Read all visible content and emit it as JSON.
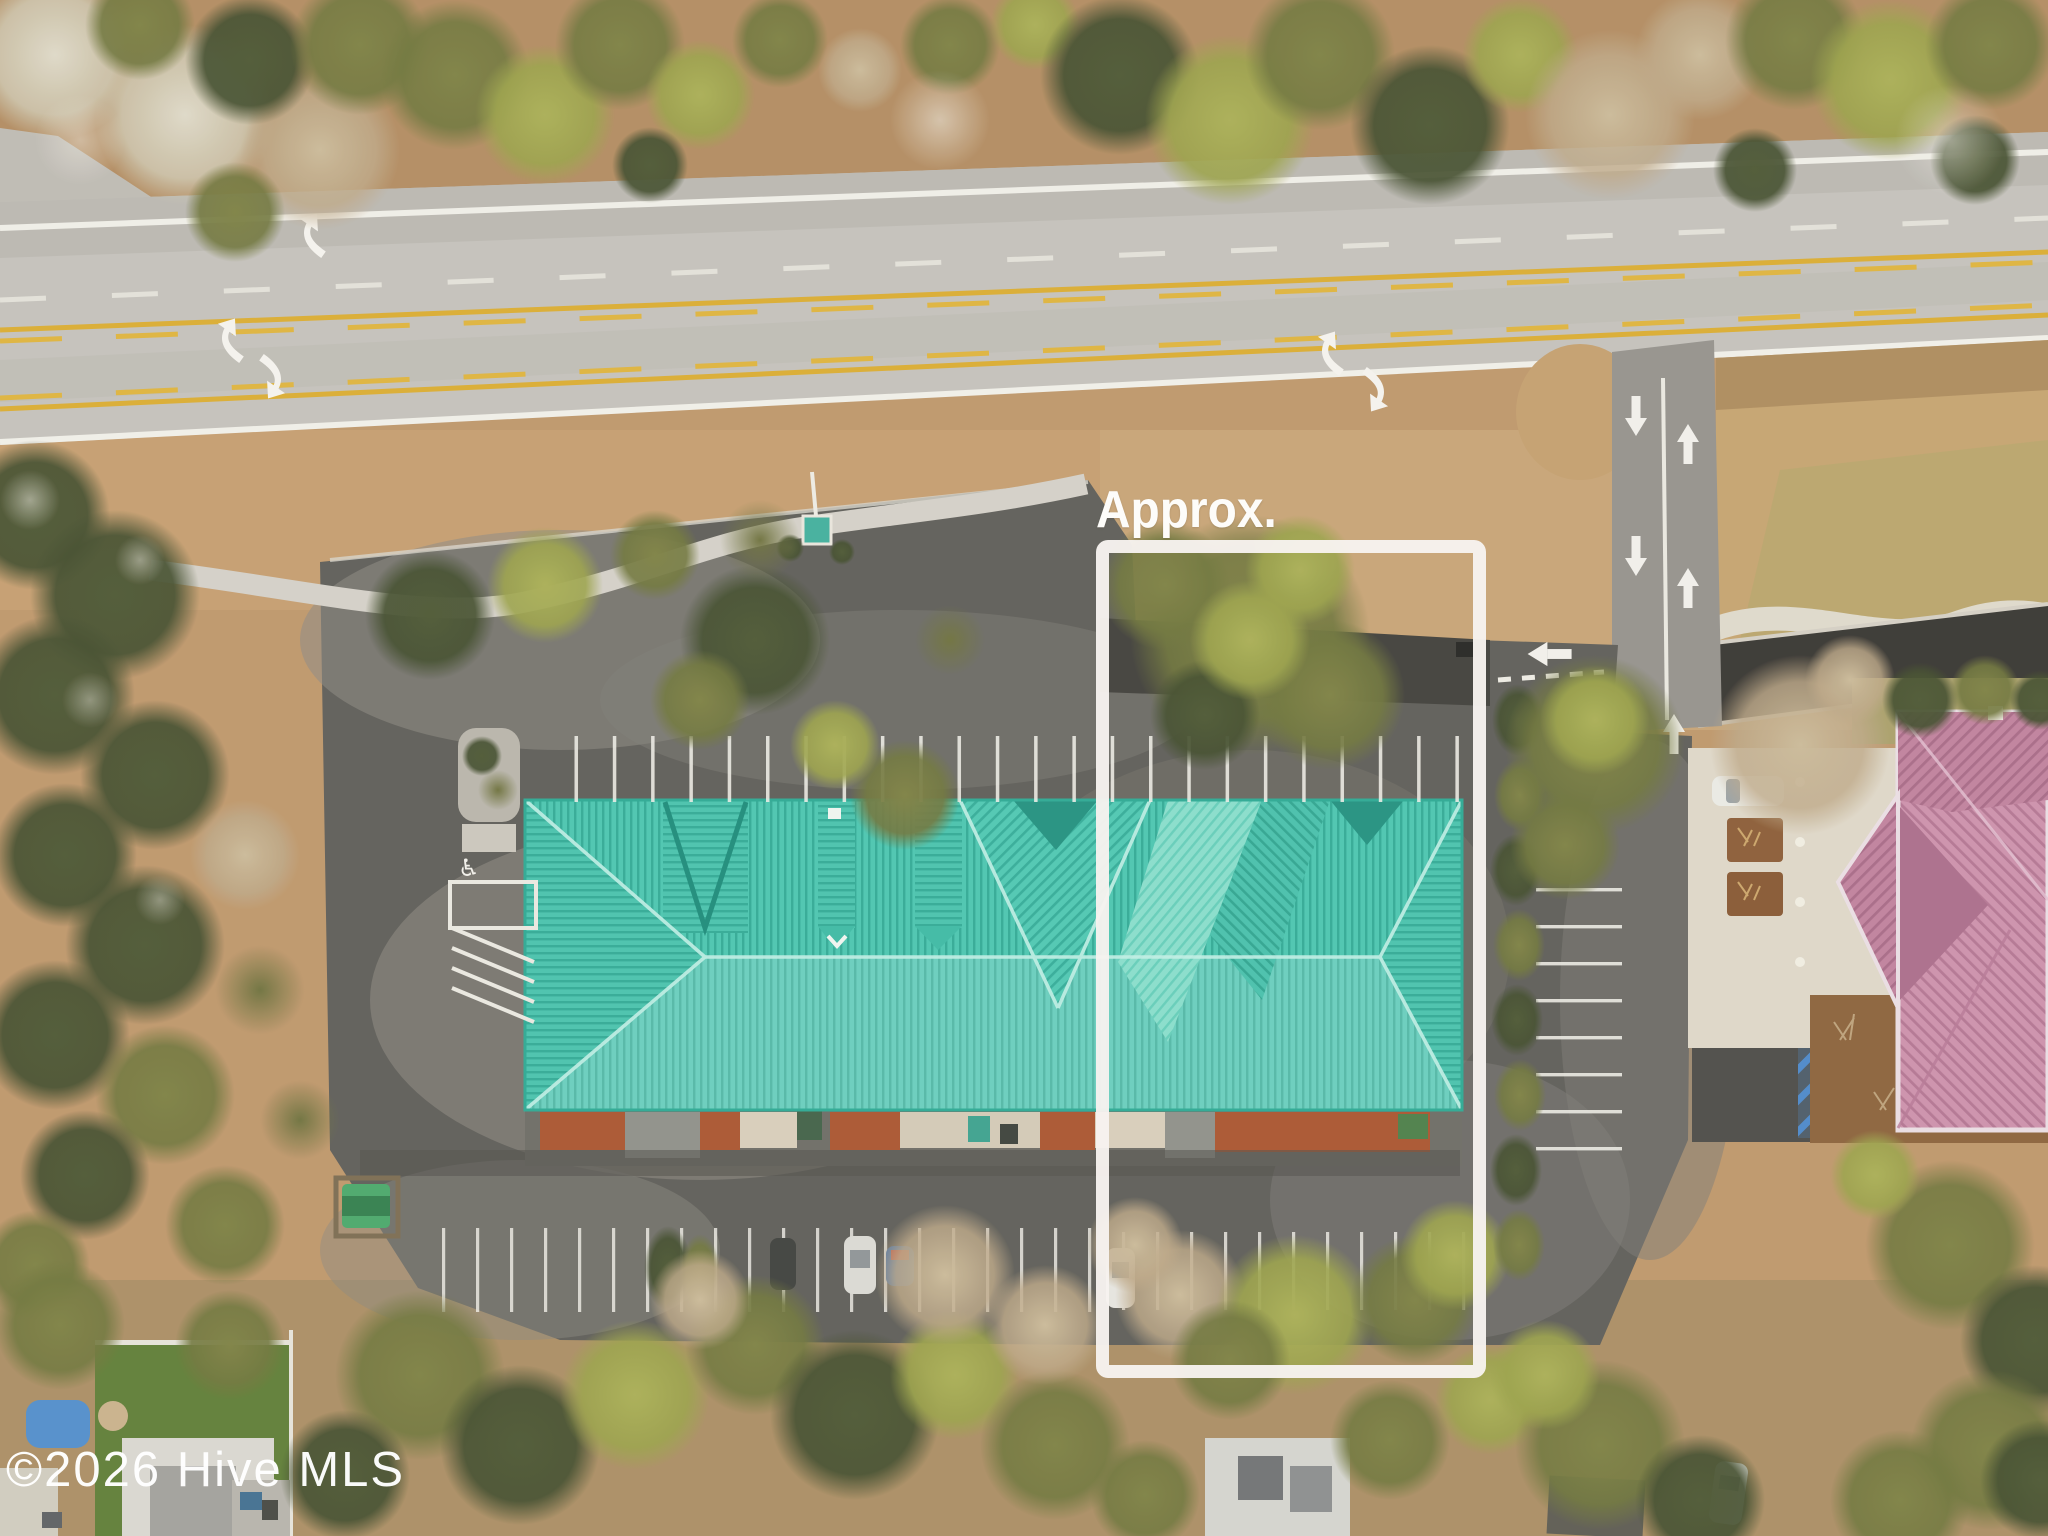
{
  "scene": {
    "type": "aerial-drone-photo",
    "annotation_label": "Approx.",
    "watermark_text": "©2026 Hive MLS",
    "boundary_color": "#f7f2ef",
    "teal_roof_color": "#49c4ae",
    "pink_roof_color": "#cb8fa9",
    "road_color": "#c3c0b9",
    "asphalt_color": "#5c5b55",
    "marking_white": "#f2f0e9",
    "marking_yellow": "#d9ab2e",
    "handicap_blue": "#4a86c8"
  }
}
